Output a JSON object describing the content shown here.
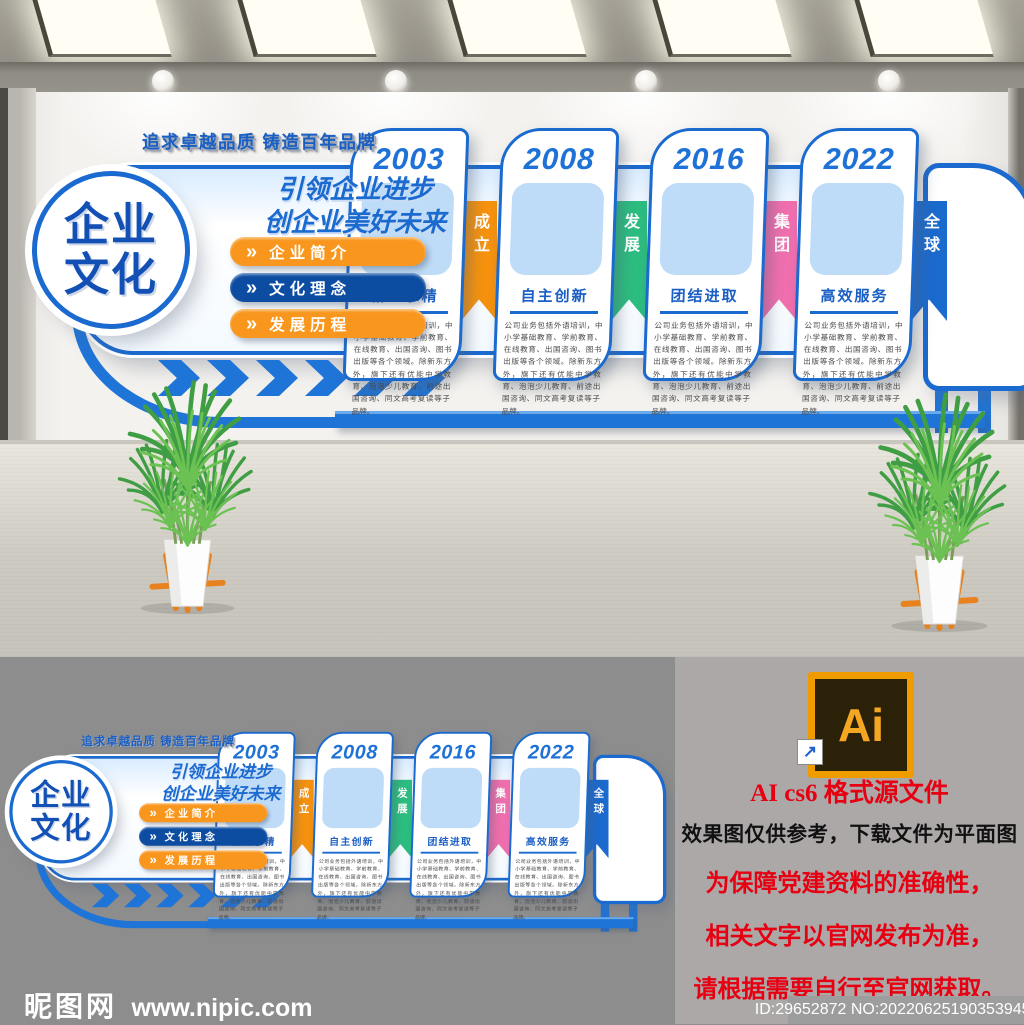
{
  "wall": {
    "tagline": "追求卓越品质 铸造百年品牌",
    "brand_line1": "企业",
    "brand_line2": "文化",
    "slogan_line1": "引领企业进步",
    "slogan_line2": "创企业美好未来",
    "menu": [
      {
        "label": "企业简介",
        "icon": "»",
        "color": "#f8961d"
      },
      {
        "label": "文化理念",
        "icon": "»",
        "color": "#0d4da1"
      },
      {
        "label": "发展历程",
        "icon": "»",
        "color": "#f8961d"
      }
    ],
    "timeline": [
      {
        "year": "2003",
        "title": "精益求精",
        "tab": "成立",
        "tab_color": "#f6920e",
        "body": "公司业务包括外语培训，中小学基础教育、学前教育、在线教育、出国咨询、图书出版等各个领域。除新东方外，旗下还有优能中学教育、泡泡少儿教育、前途出国咨询、同文高考复读等子品牌。"
      },
      {
        "year": "2008",
        "title": "自主创新",
        "tab": "发展",
        "tab_color": "#2cbd80",
        "body": "公司业务包括外语培训，中小学基础教育、学前教育、在线教育、出国咨询、图书出版等各个领域。除新东方外，旗下还有优能中学教育、泡泡少儿教育、前途出国咨询、同文高考复读等子品牌。"
      },
      {
        "year": "2016",
        "title": "团结进取",
        "tab": "集团",
        "tab_color": "#f06fae",
        "body": "公司业务包括外语培训，中小学基础教育、学前教育、在线教育、出国咨询、图书出版等各个领域。除新东方外，旗下还有优能中学教育、泡泡少儿教育、前途出国咨询、同文高考复读等子品牌。"
      },
      {
        "year": "2022",
        "title": "高效服务",
        "tab": "全球",
        "tab_color": "#1b6ace",
        "body": "公司业务包括外语培训，中小学基础教育、学前教育、在线教育、出国咨询、图书出版等各个领域。除新东方外，旗下还有优能中学教育、泡泡少儿教育、前途出国咨询、同文高考复读等子品牌。"
      }
    ],
    "accent_blue": "#1a6ad0"
  },
  "notes": {
    "ai_badge_label": "Ai",
    "shortcut_arrow": "↗",
    "title": "AI cs6 格式源文件",
    "line_black": "效果图仅供参考，下载文件为平面图",
    "line_red1": "为保障党建资料的准确性，",
    "line_red2": "相关文字以官网发布为准，",
    "line_red3": "请根据需要自行至官网获取。",
    "red_color": "#e60012",
    "id_text": "ID:29652872 NO:20220625190353945123"
  },
  "watermark": {
    "site_name": "昵图网",
    "site_url": "www.nipic.com"
  }
}
